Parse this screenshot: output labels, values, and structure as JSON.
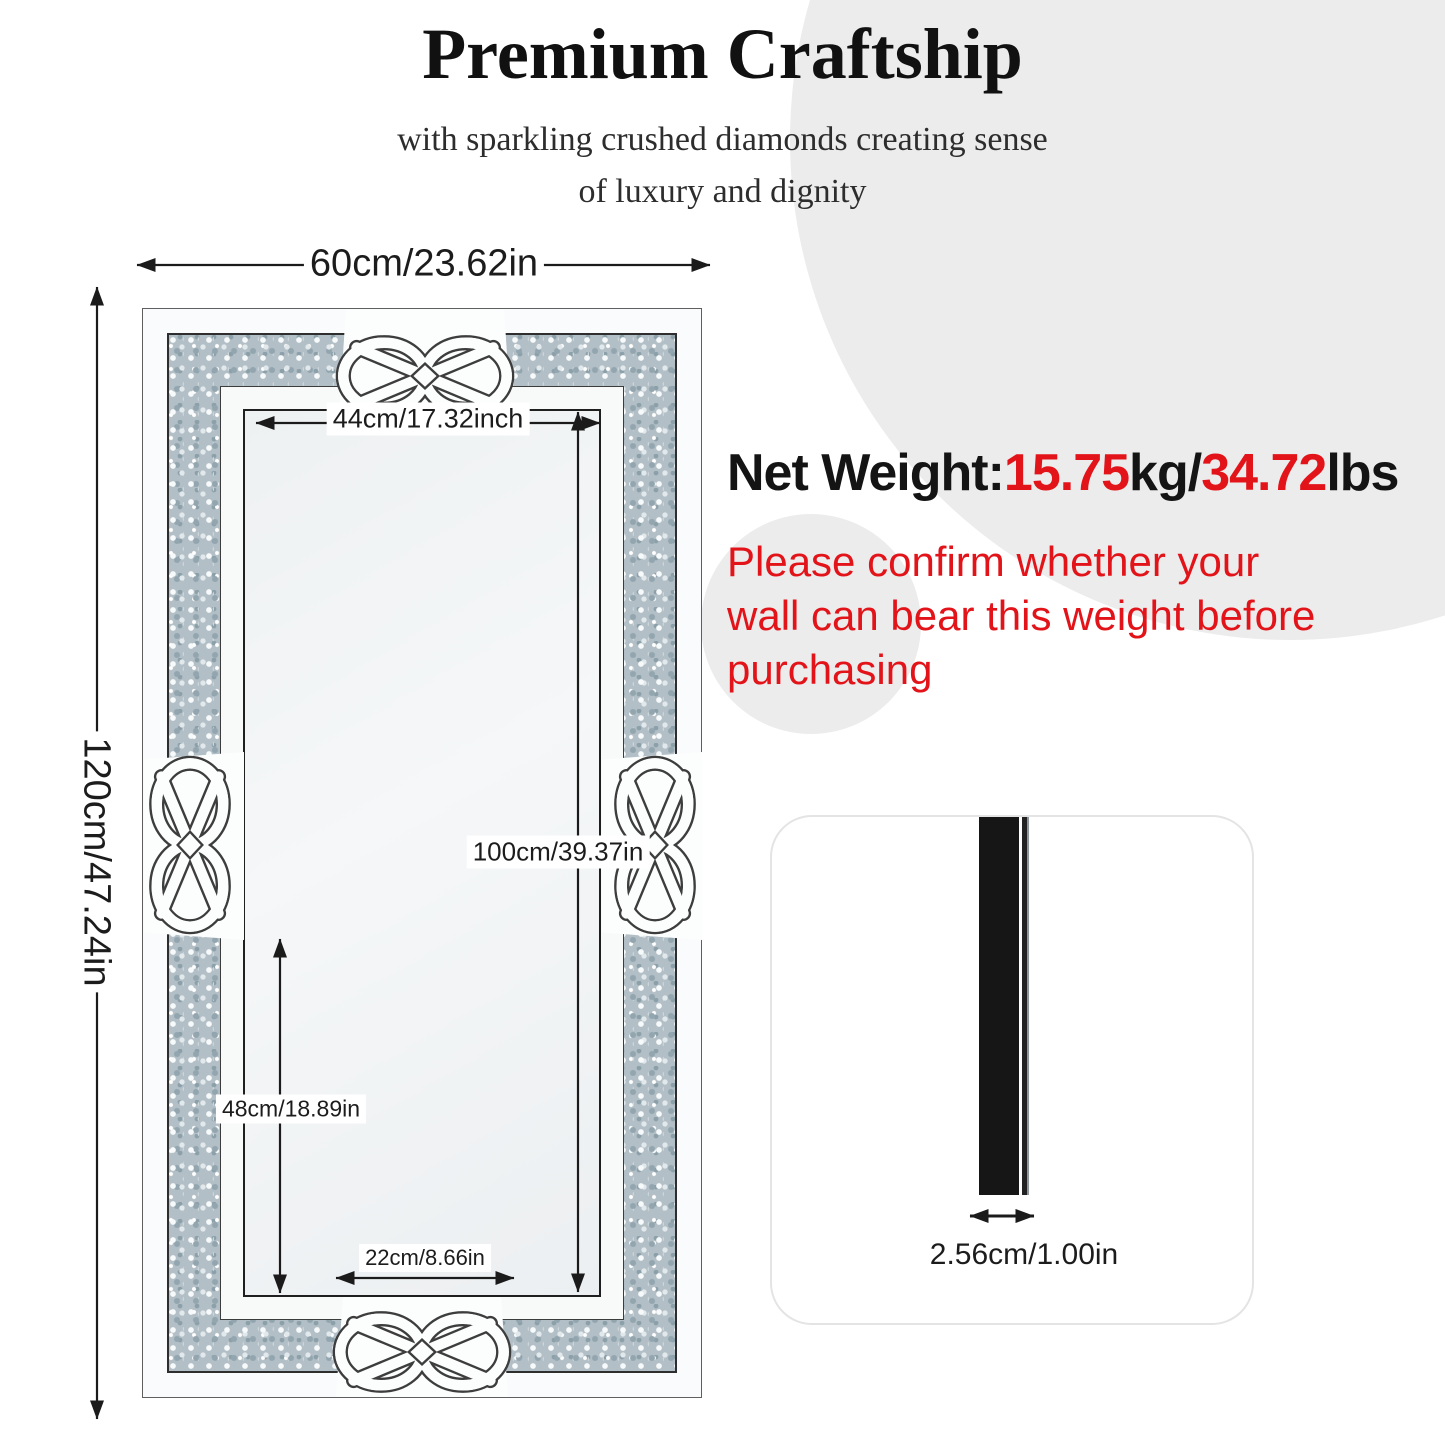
{
  "header": {
    "title": "Premium Craftship",
    "subtitle": "with sparkling crushed diamonds creating sense\nof luxury and dignity"
  },
  "diagram": {
    "outer_width_label": "60cm/23.62in",
    "outer_height_label": "120cm/47.24in",
    "inner_width_label": "44cm/17.32inch",
    "inner_height_label": "100cm/39.37in",
    "lower_height_label": "48cm/18.89in",
    "bottom_width_label": "22cm/8.66in"
  },
  "net_weight": {
    "segments": [
      {
        "text": "Net Weight:",
        "color": "#141414"
      },
      {
        "text": "15.75",
        "color": "#e2141a"
      },
      {
        "text": "kg/",
        "color": "#141414"
      },
      {
        "text": "34.72",
        "color": "#e2141a"
      },
      {
        "text": "lbs",
        "color": "#141414"
      }
    ]
  },
  "warning": {
    "text": "Please confirm whether your\nwall can bear this weight before\npurchasing",
    "color": "#e2141a"
  },
  "thickness_panel": {
    "label": "2.56cm/1.00in"
  },
  "colors": {
    "accent_red": "#e2141a",
    "text_black": "#141414",
    "decor_circle_gray": "#ececec",
    "diamond_band": "#b3bfc6"
  }
}
